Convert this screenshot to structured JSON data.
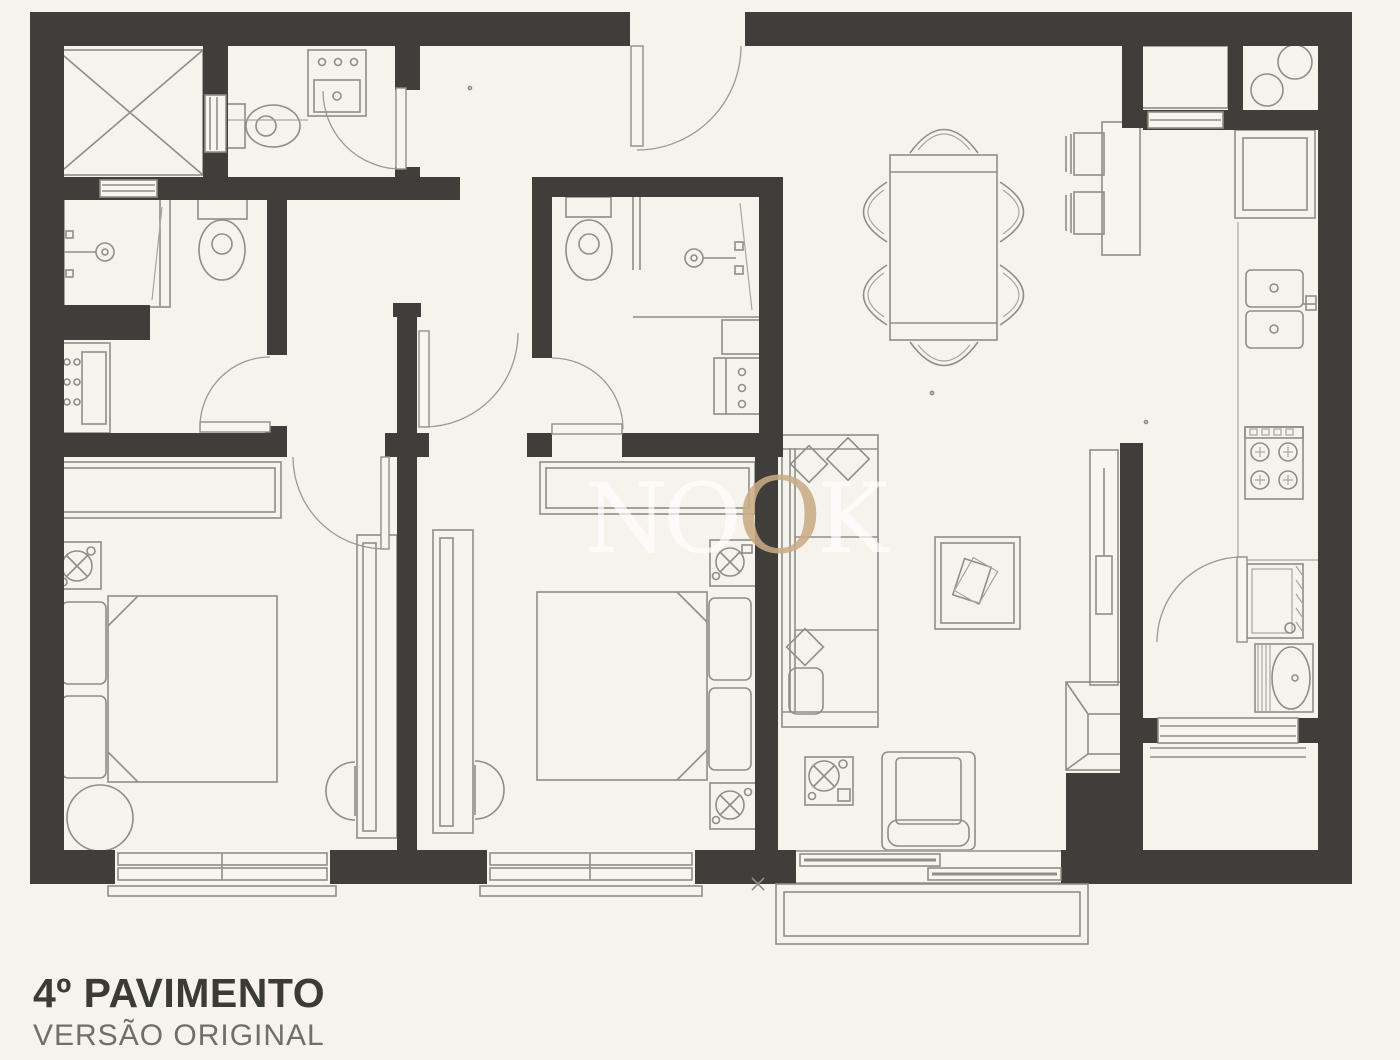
{
  "document": {
    "title": "4º PAVIMENTO",
    "subtitle": "VERSÃO ORIGINAL"
  },
  "watermark": {
    "text": "NOOK",
    "letters": [
      "N",
      "O",
      "O",
      "K"
    ]
  },
  "colors": {
    "background": "#f5f3ec",
    "wall": "#3f3e3b",
    "drawing_line": "#8e8e88",
    "watermark_tan": "#c9ab84",
    "watermark_light": "#ffffff",
    "title_text": "#3b3b36",
    "subtitle_text": "#6f6f69"
  },
  "floor_plan": {
    "type": "apartment-floor-plan",
    "rooms": [
      "elevator-shaft",
      "social-wc",
      "suite1-bathroom",
      "suite2-bathroom",
      "bedroom-1",
      "bedroom-2",
      "hall",
      "living-dining-room",
      "kitchen",
      "laundry-area",
      "balcony"
    ],
    "furniture_symbols": [
      "elevator-x-box",
      "toilet",
      "sink-vanity",
      "shower",
      "double-bed",
      "pillows",
      "wardrobe",
      "desk",
      "desk-chair",
      "round-pouf",
      "ceiling-fan-symbol",
      "dining-table-6-chairs",
      "bar-counter",
      "bar-stools",
      "refrigerator",
      "kitchen-cabinet",
      "double-kitchen-sink",
      "gas-stove-4-burners",
      "washing-machine",
      "laundry-tank",
      "sofa",
      "coffee-table",
      "armchair",
      "tv-panel",
      "corner-tv-stand",
      "sliding-window",
      "window",
      "door-swing"
    ]
  }
}
